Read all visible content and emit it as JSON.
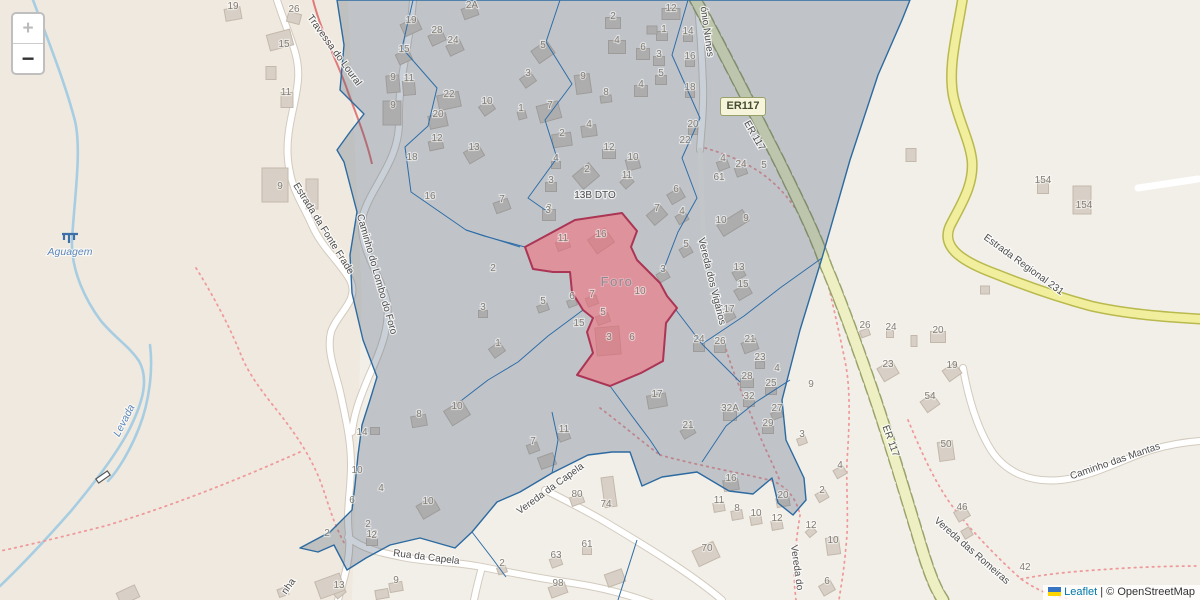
{
  "ui": {
    "zoom_in": "+",
    "zoom_out": "−",
    "attribution": {
      "leaflet": "Leaflet",
      "sep": "|",
      "osm": "© OpenStreetMap"
    }
  },
  "badge": {
    "text": "ER117"
  },
  "area_label": {
    "t": "Foro",
    "x": 617,
    "y": 286
  },
  "water_labels": [
    {
      "t": "Aguagem",
      "x": 70,
      "y": 255,
      "r": 0
    },
    {
      "t": "Levada",
      "x": 127,
      "y": 422,
      "r": -63
    }
  ],
  "street_labels": [
    {
      "t": "Travessa do Loural",
      "x": 332,
      "y": 52,
      "r": 54
    },
    {
      "t": "Estrada da Fonte Frade",
      "x": 321,
      "y": 230,
      "r": 58
    },
    {
      "t": "Caminho do Lombo do Foro",
      "x": 374,
      "y": 275,
      "r": 74
    },
    {
      "t": "ónio Nunes",
      "x": 704,
      "y": 32,
      "r": 82
    },
    {
      "t": "ER 117",
      "x": 752,
      "y": 137,
      "r": 60
    },
    {
      "t": "ER 117",
      "x": 888,
      "y": 442,
      "r": 70
    },
    {
      "t": "Vereda dos Vigários",
      "x": 709,
      "y": 282,
      "r": 76
    },
    {
      "t": "Vereda da Capela",
      "x": 552,
      "y": 491,
      "r": -36
    },
    {
      "t": "Rua da Capela",
      "x": 426,
      "y": 560,
      "r": 7
    },
    {
      "t": "Estrada Regional 231",
      "x": 1022,
      "y": 267,
      "r": 36
    },
    {
      "t": "Caminho das Mantas",
      "x": 1116,
      "y": 464,
      "r": -19
    },
    {
      "t": "Vereda das Romeiras",
      "x": 970,
      "y": 553,
      "r": 41
    },
    {
      "t": "Vereda do",
      "x": 794,
      "y": 568,
      "r": 82
    },
    {
      "t": "13B DTO",
      "x": 595,
      "y": 198,
      "r": 0
    },
    {
      "t": "nha",
      "x": 291,
      "y": 588,
      "r": -55
    }
  ],
  "house_numbers": [
    [
      "19",
      233,
      9
    ],
    [
      "26",
      294,
      12
    ],
    [
      "15",
      284,
      47
    ],
    [
      "11",
      286,
      95
    ],
    [
      "9",
      280,
      189
    ],
    [
      "19",
      411,
      23
    ],
    [
      "28",
      437,
      33
    ],
    [
      "24",
      453,
      43
    ],
    [
      "15",
      404,
      52
    ],
    [
      "9",
      393,
      80
    ],
    [
      "11",
      409,
      81
    ],
    [
      "9",
      393,
      108
    ],
    [
      "22",
      449,
      97
    ],
    [
      "20",
      438,
      117
    ],
    [
      "12",
      437,
      141
    ],
    [
      "13",
      474,
      150
    ],
    [
      "10",
      487,
      104
    ],
    [
      "18",
      412,
      160
    ],
    [
      "16",
      430,
      199
    ],
    [
      "2A",
      472,
      8
    ],
    [
      "5",
      543,
      48
    ],
    [
      "3",
      528,
      76
    ],
    [
      "1",
      521,
      111
    ],
    [
      "7",
      550,
      108
    ],
    [
      "12",
      671,
      11
    ],
    [
      "2",
      613,
      19
    ],
    [
      "4",
      617,
      43
    ],
    [
      "6",
      643,
      50
    ],
    [
      "1",
      664,
      32
    ],
    [
      "3",
      659,
      57
    ],
    [
      "5",
      661,
      76
    ],
    [
      "4",
      641,
      87
    ],
    [
      "9",
      583,
      79
    ],
    [
      "8",
      606,
      95
    ],
    [
      "4",
      589,
      127
    ],
    [
      "2",
      562,
      136
    ],
    [
      "4",
      556,
      161
    ],
    [
      "2",
      587,
      172
    ],
    [
      "3",
      551,
      183
    ],
    [
      "3",
      549,
      211
    ],
    [
      "7",
      502,
      202
    ],
    [
      "12",
      609,
      150
    ],
    [
      "10",
      633,
      160
    ],
    [
      "11",
      627,
      178
    ],
    [
      "6",
      676,
      192
    ],
    [
      "7",
      657,
      211
    ],
    [
      "14",
      688,
      34
    ],
    [
      "16",
      690,
      59
    ],
    [
      "18",
      690,
      90
    ],
    [
      "20",
      693,
      127
    ],
    [
      "22",
      685,
      143
    ],
    [
      "4",
      723,
      161
    ],
    [
      "24",
      741,
      167
    ],
    [
      "5",
      764,
      168
    ],
    [
      "61",
      719,
      180
    ],
    [
      "4",
      682,
      214
    ],
    [
      "10",
      721,
      223
    ],
    [
      "9",
      746,
      221
    ],
    [
      "5",
      686,
      247
    ],
    [
      "3",
      663,
      272
    ],
    [
      "13",
      739,
      270
    ],
    [
      "15",
      743,
      287
    ],
    [
      "17",
      729,
      312
    ],
    [
      "24",
      699,
      342
    ],
    [
      "26",
      720,
      344
    ],
    [
      "21",
      750,
      342
    ],
    [
      "23",
      760,
      360
    ],
    [
      "4",
      777,
      371
    ],
    [
      "28",
      747,
      379
    ],
    [
      "25",
      771,
      386
    ],
    [
      "32",
      749,
      399
    ],
    [
      "32A",
      730,
      411
    ],
    [
      "27",
      777,
      411
    ],
    [
      "29",
      768,
      426
    ],
    [
      "9",
      811,
      387
    ],
    [
      "3",
      802,
      437
    ],
    [
      "17",
      657,
      397
    ],
    [
      "21",
      688,
      428
    ],
    [
      "3",
      548,
      213
    ],
    [
      "11",
      563,
      241
    ],
    [
      "16",
      601,
      237
    ],
    [
      "2",
      493,
      271
    ],
    [
      "10",
      640,
      294
    ],
    [
      "7",
      592,
      297
    ],
    [
      "6",
      572,
      299
    ],
    [
      "5",
      603,
      315
    ],
    [
      "15",
      579,
      326
    ],
    [
      "3",
      609,
      340
    ],
    [
      "6",
      632,
      340
    ],
    [
      "5",
      543,
      304
    ],
    [
      "1",
      498,
      346
    ],
    [
      "3",
      483,
      310
    ],
    [
      "8",
      419,
      417
    ],
    [
      "10",
      457,
      409
    ],
    [
      "14",
      362,
      435
    ],
    [
      "10",
      357,
      473
    ],
    [
      "4",
      381,
      491
    ],
    [
      "6",
      352,
      503
    ],
    [
      "2",
      368,
      527
    ],
    [
      "12",
      372,
      537
    ],
    [
      "10",
      428,
      504
    ],
    [
      "9",
      396,
      583
    ],
    [
      "13",
      339,
      588
    ],
    [
      "2",
      327,
      536
    ],
    [
      "2",
      374,
      538
    ],
    [
      "7",
      533,
      444
    ],
    [
      "11",
      564,
      432
    ],
    [
      "80",
      577,
      497
    ],
    [
      "74",
      606,
      507
    ],
    [
      "61",
      587,
      547
    ],
    [
      "63",
      556,
      558
    ],
    [
      "98",
      558,
      586
    ],
    [
      "2",
      502,
      566
    ],
    [
      "16",
      731,
      481
    ],
    [
      "20",
      783,
      498
    ],
    [
      "11",
      719,
      503
    ],
    [
      "8",
      737,
      511
    ],
    [
      "10",
      756,
      516
    ],
    [
      "12",
      777,
      521
    ],
    [
      "12",
      811,
      528
    ],
    [
      "10",
      833,
      543
    ],
    [
      "6",
      827,
      584
    ],
    [
      "70",
      707,
      551
    ],
    [
      "50",
      946,
      447
    ],
    [
      "46",
      962,
      510
    ],
    [
      "42",
      1025,
      570
    ],
    [
      "4",
      840,
      468
    ],
    [
      "2",
      822,
      493
    ],
    [
      "26",
      865,
      328
    ],
    [
      "24",
      891,
      330
    ],
    [
      "20",
      938,
      333
    ],
    [
      "23",
      888,
      367
    ],
    [
      "19",
      952,
      368
    ],
    [
      "54",
      930,
      399
    ],
    [
      "154",
      1043,
      183
    ],
    [
      "154",
      1084,
      208
    ]
  ],
  "buildings": [
    [
      233,
      14,
      16,
      12,
      -10
    ],
    [
      294,
      18,
      13,
      10,
      15
    ],
    [
      280,
      40,
      24,
      16,
      -15
    ],
    [
      271,
      73,
      10,
      13,
      0
    ],
    [
      287,
      100,
      12,
      15,
      0
    ],
    [
      275,
      185,
      26,
      34,
      0
    ],
    [
      312,
      194,
      12,
      30,
      0
    ],
    [
      411,
      27,
      18,
      13,
      -25
    ],
    [
      437,
      38,
      15,
      11,
      -25
    ],
    [
      455,
      48,
      15,
      11,
      -25
    ],
    [
      404,
      57,
      14,
      11,
      -25
    ],
    [
      393,
      84,
      13,
      17,
      -5
    ],
    [
      409,
      88,
      12,
      14,
      -5
    ],
    [
      392,
      113,
      18,
      24,
      0
    ],
    [
      449,
      101,
      22,
      15,
      -12
    ],
    [
      438,
      121,
      18,
      13,
      -12
    ],
    [
      436,
      145,
      14,
      9,
      -12
    ],
    [
      474,
      154,
      17,
      13,
      -30
    ],
    [
      487,
      108,
      13,
      11,
      -35
    ],
    [
      470,
      12,
      15,
      11,
      -20
    ],
    [
      543,
      52,
      19,
      15,
      -35
    ],
    [
      528,
      80,
      13,
      11,
      -35
    ],
    [
      549,
      112,
      22,
      17,
      -15
    ],
    [
      522,
      115,
      8,
      8,
      -15
    ],
    [
      613,
      23,
      15,
      11,
      0
    ],
    [
      617,
      47,
      17,
      13,
      0
    ],
    [
      643,
      54,
      13,
      11,
      0
    ],
    [
      662,
      36,
      11,
      9,
      0
    ],
    [
      659,
      61,
      11,
      9,
      0
    ],
    [
      661,
      80,
      11,
      9,
      0
    ],
    [
      641,
      91,
      13,
      11,
      0
    ],
    [
      671,
      14,
      18,
      11,
      0
    ],
    [
      652,
      30,
      10,
      8,
      0
    ],
    [
      583,
      84,
      15,
      19,
      -8
    ],
    [
      606,
      99,
      11,
      7,
      -8
    ],
    [
      589,
      131,
      15,
      11,
      -8
    ],
    [
      562,
      140,
      19,
      13,
      -8
    ],
    [
      556,
      165,
      9,
      7,
      0
    ],
    [
      586,
      176,
      21,
      17,
      -40
    ],
    [
      551,
      187,
      11,
      9,
      0
    ],
    [
      549,
      215,
      13,
      11,
      0
    ],
    [
      502,
      206,
      15,
      11,
      -20
    ],
    [
      609,
      154,
      13,
      9,
      0
    ],
    [
      633,
      164,
      13,
      11,
      -15
    ],
    [
      627,
      182,
      11,
      9,
      -42
    ],
    [
      676,
      196,
      15,
      11,
      -30
    ],
    [
      657,
      215,
      17,
      13,
      -40
    ],
    [
      688,
      38,
      9,
      7,
      0
    ],
    [
      690,
      63,
      9,
      7,
      0
    ],
    [
      690,
      94,
      9,
      7,
      0
    ],
    [
      693,
      131,
      9,
      7,
      0
    ],
    [
      723,
      165,
      11,
      9,
      -20
    ],
    [
      741,
      171,
      11,
      9,
      -20
    ],
    [
      682,
      218,
      11,
      9,
      -30
    ],
    [
      733,
      223,
      30,
      13,
      -32
    ],
    [
      686,
      251,
      11,
      9,
      -30
    ],
    [
      663,
      276,
      11,
      9,
      -30
    ],
    [
      739,
      274,
      11,
      9,
      -30
    ],
    [
      743,
      292,
      15,
      11,
      -30
    ],
    [
      729,
      316,
      11,
      9,
      -30
    ],
    [
      699,
      347,
      11,
      9,
      0
    ],
    [
      720,
      348,
      11,
      9,
      0
    ],
    [
      750,
      346,
      15,
      11,
      -20
    ],
    [
      760,
      365,
      9,
      7,
      0
    ],
    [
      747,
      383,
      13,
      9,
      0
    ],
    [
      771,
      391,
      11,
      7,
      0
    ],
    [
      749,
      403,
      11,
      7,
      0
    ],
    [
      730,
      416,
      13,
      9,
      0
    ],
    [
      777,
      415,
      11,
      7,
      -20
    ],
    [
      768,
      430,
      11,
      7,
      0
    ],
    [
      802,
      441,
      9,
      7,
      -20
    ],
    [
      657,
      401,
      19,
      13,
      -10
    ],
    [
      688,
      432,
      13,
      9,
      -30
    ],
    [
      563,
      245,
      13,
      9,
      -20
    ],
    [
      601,
      241,
      21,
      17,
      -35
    ],
    [
      592,
      301,
      11,
      9,
      -20
    ],
    [
      572,
      303,
      9,
      7,
      -20
    ],
    [
      603,
      319,
      13,
      9,
      -20
    ],
    [
      608,
      341,
      24,
      28,
      -5
    ],
    [
      543,
      308,
      11,
      7,
      -20
    ],
    [
      497,
      350,
      13,
      11,
      -35
    ],
    [
      483,
      314,
      9,
      7,
      0
    ],
    [
      419,
      421,
      15,
      11,
      -10
    ],
    [
      457,
      413,
      21,
      17,
      -32
    ],
    [
      375,
      431,
      9,
      7,
      0
    ],
    [
      428,
      508,
      19,
      15,
      -30
    ],
    [
      372,
      541,
      11,
      9,
      0
    ],
    [
      396,
      587,
      13,
      9,
      -10
    ],
    [
      339,
      592,
      11,
      9,
      -40
    ],
    [
      533,
      448,
      11,
      9,
      -20
    ],
    [
      564,
      436,
      11,
      9,
      -20
    ],
    [
      547,
      461,
      16,
      12,
      -20
    ],
    [
      577,
      500,
      13,
      9,
      -20
    ],
    [
      609,
      492,
      12,
      30,
      -8
    ],
    [
      587,
      551,
      9,
      7,
      0
    ],
    [
      556,
      562,
      11,
      9,
      -20
    ],
    [
      558,
      590,
      17,
      11,
      -20
    ],
    [
      502,
      570,
      9,
      7,
      -20
    ],
    [
      615,
      578,
      18,
      13,
      -20
    ],
    [
      731,
      485,
      15,
      11,
      -10
    ],
    [
      719,
      507,
      11,
      9,
      -10
    ],
    [
      737,
      515,
      11,
      9,
      -10
    ],
    [
      756,
      520,
      11,
      9,
      -10
    ],
    [
      777,
      525,
      11,
      9,
      -10
    ],
    [
      783,
      502,
      13,
      9,
      -10
    ],
    [
      811,
      532,
      9,
      7,
      -40
    ],
    [
      833,
      546,
      13,
      17,
      -8
    ],
    [
      827,
      588,
      13,
      11,
      -30
    ],
    [
      706,
      554,
      23,
      17,
      -25
    ],
    [
      946,
      451,
      15,
      19,
      -8
    ],
    [
      962,
      514,
      13,
      11,
      -30
    ],
    [
      967,
      533,
      9,
      9,
      -30
    ],
    [
      840,
      472,
      11,
      9,
      -30
    ],
    [
      822,
      496,
      11,
      9,
      -30
    ],
    [
      865,
      333,
      9,
      7,
      -20
    ],
    [
      890,
      334,
      7,
      7,
      0
    ],
    [
      938,
      337,
      15,
      11,
      0
    ],
    [
      914,
      341,
      6,
      11,
      0
    ],
    [
      888,
      371,
      17,
      15,
      -30
    ],
    [
      952,
      372,
      15,
      13,
      -35
    ],
    [
      930,
      403,
      15,
      13,
      -35
    ],
    [
      1043,
      187,
      11,
      13,
      0
    ],
    [
      1082,
      200,
      18,
      28,
      0
    ],
    [
      985,
      290,
      9,
      8,
      0
    ],
    [
      911,
      155,
      10,
      13,
      0
    ],
    [
      330,
      586,
      26,
      18,
      -20
    ],
    [
      382,
      594,
      13,
      9,
      -10
    ],
    [
      283,
      592,
      10,
      8,
      -20
    ],
    [
      128,
      595,
      20,
      13,
      -25
    ]
  ],
  "colors": {
    "land": "#f2efe9",
    "land_left": "#f0e9df",
    "building_fill": "#d8d0c6",
    "building_stroke": "#c3b8ab",
    "road_white": "#ffffff",
    "road_casing": "#d2cabd",
    "er117_fill": "#eef0c4",
    "er117_casing": "#9aa36b",
    "er231_fill": "#f1ef9e",
    "er231_casing": "#b9b94e",
    "stream": "#a7cde2",
    "path_red": "#ef9a9a",
    "overlay_fill": "rgba(60,80,110,0.27)",
    "overlay_stroke": "#2c6aa0",
    "foro_fill": "rgba(245,105,120,0.55)",
    "foro_stroke": "#ab3555"
  }
}
